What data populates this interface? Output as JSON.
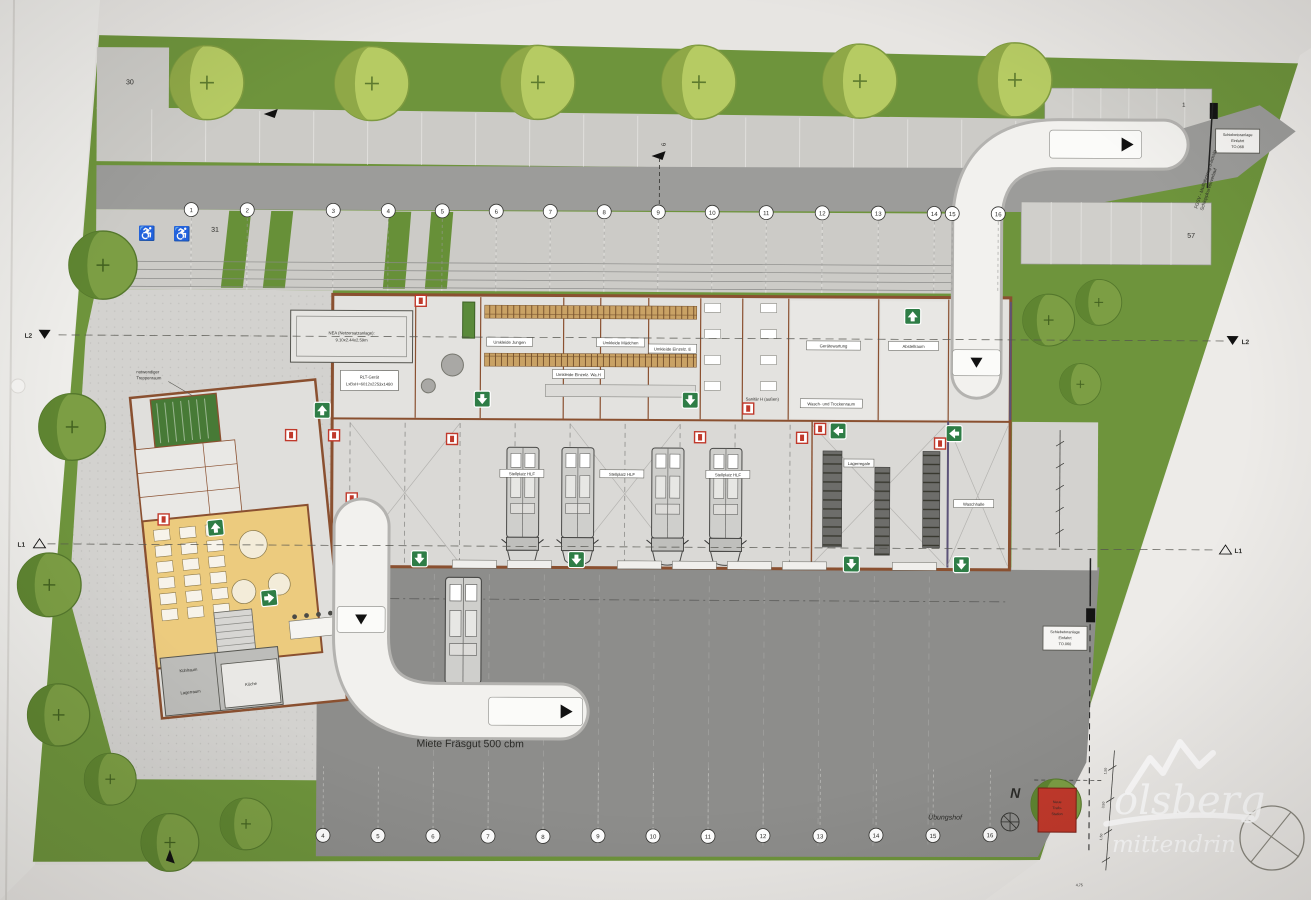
{
  "plan": {
    "axes": {
      "top": [
        "1",
        "2",
        "3",
        "4",
        "5",
        "6",
        "7",
        "8",
        "9",
        "10",
        "11",
        "12",
        "13",
        "14",
        "15",
        "16"
      ],
      "bottom": [
        "4",
        "5",
        "6",
        "7",
        "8",
        "9",
        "10",
        "11",
        "12",
        "13",
        "14",
        "15",
        "16"
      ],
      "l1": "L1",
      "l2": "L2",
      "road_marker": "6"
    },
    "signs": {
      "gate_top": [
        "Schiebetoranlage",
        "Einfahrt",
        "TO.068"
      ],
      "gate_mid": [
        "Schiebetoranlage",
        "Einfahrt",
        "TO.060"
      ]
    },
    "notes": {
      "fgsv1": "FGSV - Müllfahrzeug 3-achsig",
      "fgsv2": "Schleppkurvenverlauf",
      "miete": "Miete Fräsgut 500 cbm",
      "uebungshof": "Übungshof",
      "treppenraum1": "notwendiger",
      "treppenraum2": "Treppenraum"
    },
    "parking": {
      "p30": "30",
      "p31": "31",
      "p57": "57",
      "p1": "1"
    },
    "north": "N",
    "trafo": [
      "Neue",
      "Trafo-",
      "Station"
    ],
    "rooms": {
      "nea1": "NEA (Netzersatzanlage):",
      "nea2": "9.10x2.44x2.59m",
      "rlt1": "RLT-Gerät",
      "rlt2": "LxBxH=6012x2253x1480",
      "umkleide_jungen": "Umkleide Jungen",
      "umkleide_maedchen": "Umkleide Mädchen",
      "umkleide_einzel_e": "Umkleide Einzelz. E",
      "umkleide_einzel_w": "Umkleide Einzelz. Wa.H",
      "geraetewartung": "Gerätewartung",
      "abstellraum": "Abstellraum",
      "wasch_trocken": "Wasch- und Trockenraum",
      "sanitaer": "Sanitär H (außen)",
      "waschhalle": "Waschhalle",
      "lagerregale": "Lagerregale",
      "stellplatz": "Stellplatz HLF",
      "kuehlraum": "Kühlraum",
      "lagerraum": "Lagerraum",
      "kueche": "Küche"
    },
    "dims": [
      "1,50",
      "3,50",
      "1,50",
      "4,75"
    ],
    "watermark": {
      "line1": "olsberg",
      "line2": "mittendrin"
    },
    "colors": {
      "site_green": "#6e943c",
      "road_gray": "#9c9c9a",
      "parking_gray": "#cccbc7",
      "yard_gray": "#8d8d8b",
      "wall_brown": "#8a5030",
      "social_tan": "#eccb7e",
      "stair_green": "#477a36",
      "exit_green": "#2e7d46",
      "alert_red": "#c2392b",
      "paper": "#e7e5e2"
    }
  }
}
